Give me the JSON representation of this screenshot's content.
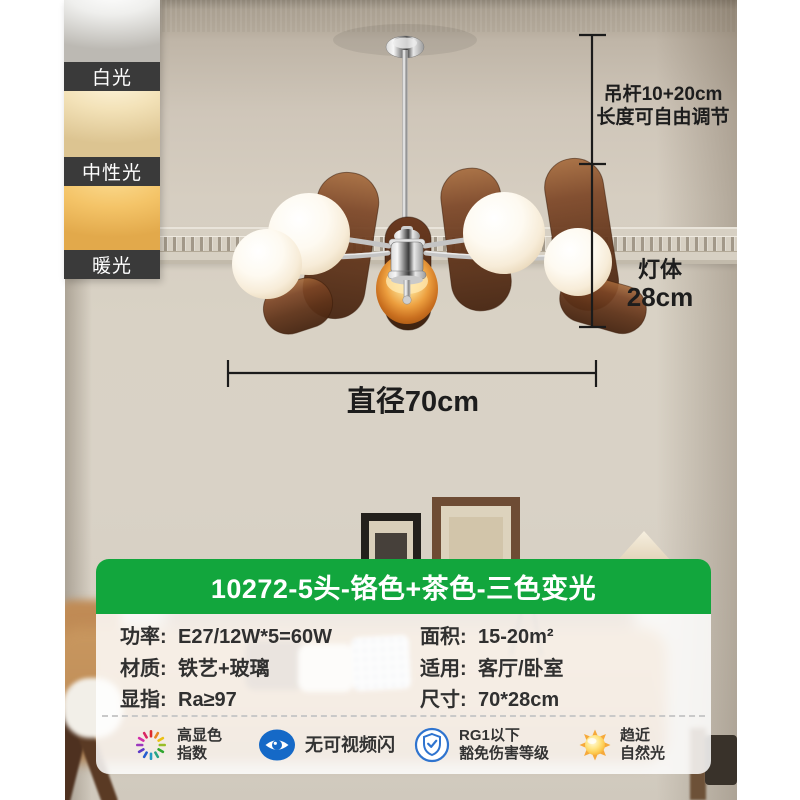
{
  "colors": {
    "accent_green": "#12a63d",
    "swatch_bar": "#3a3a3a",
    "annotation": "#1d1d1d"
  },
  "swatches": {
    "items": [
      {
        "label": "白光"
      },
      {
        "label": "中性光"
      },
      {
        "label": "暖光"
      }
    ]
  },
  "annotations": {
    "rod": {
      "line1": "吊杆10+20cm",
      "line2": "长度可自由调节"
    },
    "body": {
      "line1": "灯体",
      "line2": "28cm"
    },
    "diameter": {
      "label": "直径70cm"
    }
  },
  "card": {
    "title": "10272-5头-铬色+茶色-三色变光",
    "specs": [
      {
        "label": "功率:",
        "value": "E27/12W*5=60W"
      },
      {
        "label": "材质:",
        "value": "铁艺+玻璃"
      },
      {
        "label": "显指:",
        "value": "Ra≥97"
      },
      {
        "label": "面积:",
        "value": "15-20m²"
      },
      {
        "label": "适用:",
        "value": "客厅/卧室"
      },
      {
        "label": "尺寸:",
        "value": "70*28cm"
      }
    ],
    "features": [
      {
        "icon": "color-wheel-icon",
        "text1": "高显色",
        "text2": "指数"
      },
      {
        "icon": "eye-icon",
        "text1": "无可视频闪",
        "text2": ""
      },
      {
        "icon": "shield-check-icon",
        "text1": "RG1以下",
        "text2": "豁免伤害等级"
      },
      {
        "icon": "sun-icon",
        "text1": "趋近",
        "text2": "自然光"
      }
    ]
  }
}
